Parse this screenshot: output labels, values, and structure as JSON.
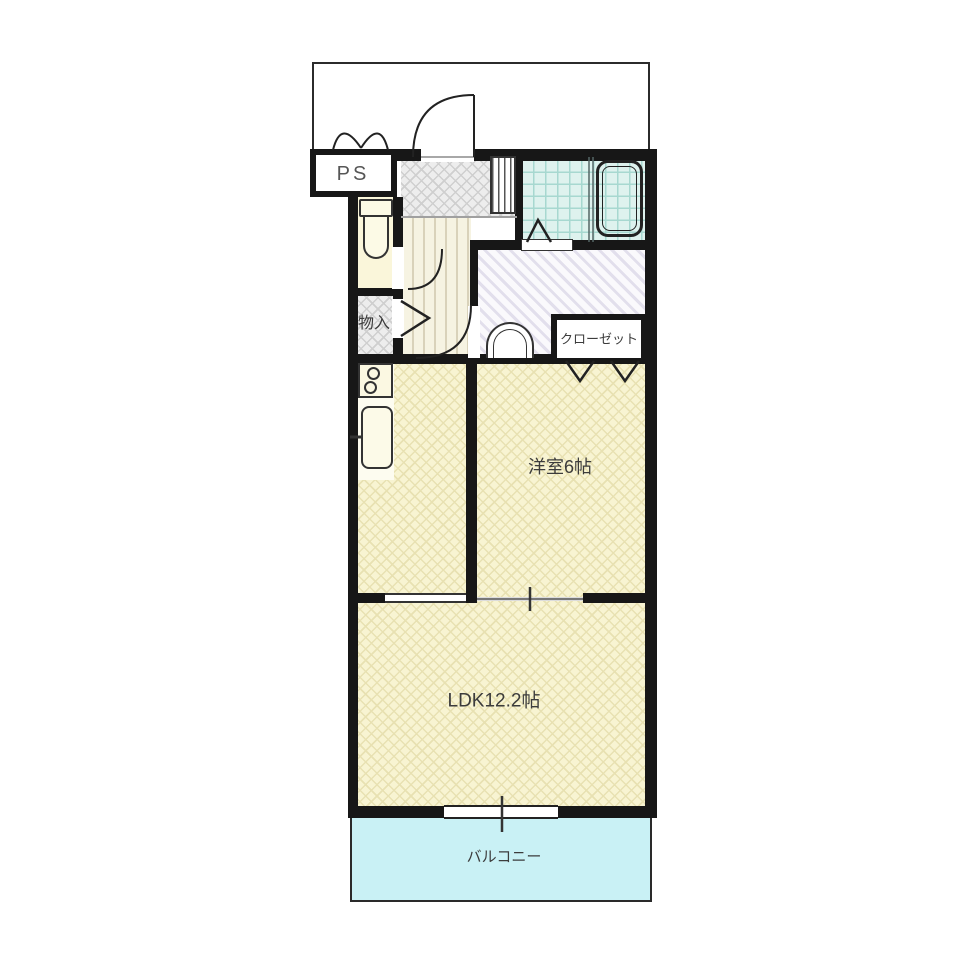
{
  "floorplan": {
    "type": "apartment-floor-plan",
    "labels": {
      "ps": "PS",
      "storage": "物入",
      "closet": "クローゼット",
      "western_room": "洋室6帖",
      "ldk": "LDK12.2帖",
      "balcony": "バルコニー"
    },
    "rooms": [
      {
        "name": "pipe-space",
        "label": "PS"
      },
      {
        "name": "toilet",
        "label": ""
      },
      {
        "name": "storage",
        "label": "物入"
      },
      {
        "name": "entrance-hall",
        "label": ""
      },
      {
        "name": "hallway",
        "label": ""
      },
      {
        "name": "bathroom",
        "label": ""
      },
      {
        "name": "washroom",
        "label": ""
      },
      {
        "name": "closet",
        "label": "クローゼット"
      },
      {
        "name": "western-room",
        "label": "洋室6帖",
        "size_tatami": 6
      },
      {
        "name": "ldk",
        "label": "LDK12.2帖",
        "size_tatami": 12.2
      },
      {
        "name": "balcony",
        "label": "バルコニー"
      }
    ],
    "colors": {
      "wall": "#171717",
      "room_yellow": "#f8f4d2",
      "room_yellow_line": "#e8e1b2",
      "balcony_cyan": "#c9f1f5",
      "bath_cyan": "#def2ee",
      "bath_grid": "#a7d8d0",
      "genkan_grey": "#ededed",
      "genkan_line": "#cfcfcf",
      "hall_bg": "#f6f3e2",
      "hall_line": "#d9d2ba",
      "wash_bg": "#faf9fc",
      "wash_line": "#e2dfec",
      "toilet_bg": "#faf6da",
      "label_color": "#3c3c3c"
    }
  }
}
